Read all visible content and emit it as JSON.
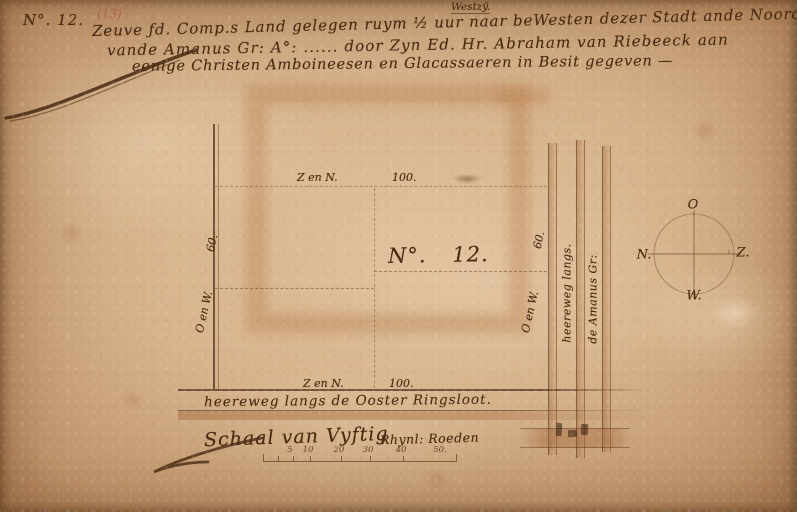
{
  "document": {
    "corner_number": "N°. 12.",
    "corner_number_alt": "(13)",
    "header": {
      "line1": "Zeuve ƒd. Comp.s Land gelegen ruym ½ uur naar beWesten dezer Stadt ande Noord Zÿ",
      "line1_insertion": "Westzÿ.",
      "line2": "vande Amanus Gr: A°: ...... door Zyn Ed. Hr. Abraham van Riebeeck aan",
      "line3": "eenige Christen Amboineesen en Glacassaeren in Besit gegeven —"
    }
  },
  "plot": {
    "label": "N°. 12.",
    "top_edge_side": "Z en N.",
    "top_edge_length": "100.",
    "bottom_edge_side": "Z en N.",
    "bottom_edge_length": "100.",
    "left_edge_side": "O en W.",
    "left_edge_length": "60.",
    "right_edge_side": "O en W.",
    "right_edge_length": "60."
  },
  "roads": {
    "vertical_label_1": "heereweg langs.",
    "vertical_label_2": "de Amanus Gr:",
    "horizontal_label": "heereweg langs de Ooster Ringsloot."
  },
  "scale": {
    "title": "Schaal van Vyftig",
    "unit": "Rhynl: Roeden",
    "ticks": [
      "5",
      "10",
      "20",
      "30",
      "40",
      "50."
    ]
  },
  "compass": {
    "top": "O",
    "left": "N.",
    "right": "Z.",
    "bottom": "W."
  },
  "colors": {
    "paper": "#d7b48d",
    "ink": "#48290f",
    "wash": "#a0643c",
    "ghost_bleed": "#b07a46"
  }
}
